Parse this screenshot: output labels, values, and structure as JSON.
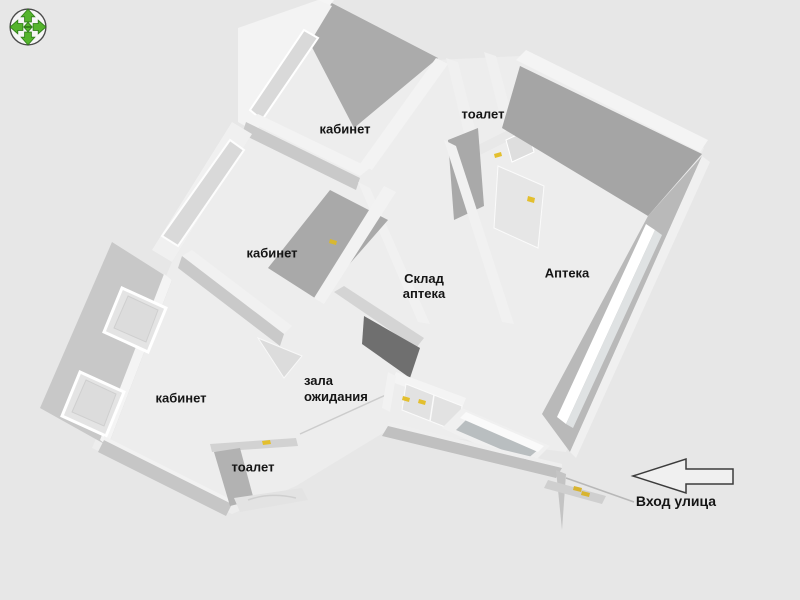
{
  "app": {
    "type": "3d-floorplan-viewer",
    "colors": {
      "background": "#e7e7e7",
      "floor": "#ededed",
      "wall_white": "#f3f3f3",
      "wall_light": "#c9c9c9",
      "wall_medium": "#ababab",
      "wall_dark": "#6f6f6f",
      "glass": "#d9d9d9",
      "door_handle_yellow": "#e3bf2e",
      "pan_arrow_green": "#55b42d",
      "text": "#151515",
      "arrow_outline": "#3c3c3c"
    }
  },
  "controls": {
    "pan_icon_name": "pan-arrows-compass"
  },
  "rooms": {
    "kabinet_top": "кабинет",
    "toalet_top": "тоалет",
    "kabinet_middle": "кабинет",
    "sklad_line1": "Склад",
    "sklad_line2": "аптека",
    "apteka": "Аптека",
    "zala_line1": "зала",
    "zala_line2": "ожидания",
    "kabinet_bottom": "кабинет",
    "toalet_bottom": "тоалет"
  },
  "entrance": {
    "label": "Вход улица",
    "arrow_direction": "left"
  }
}
